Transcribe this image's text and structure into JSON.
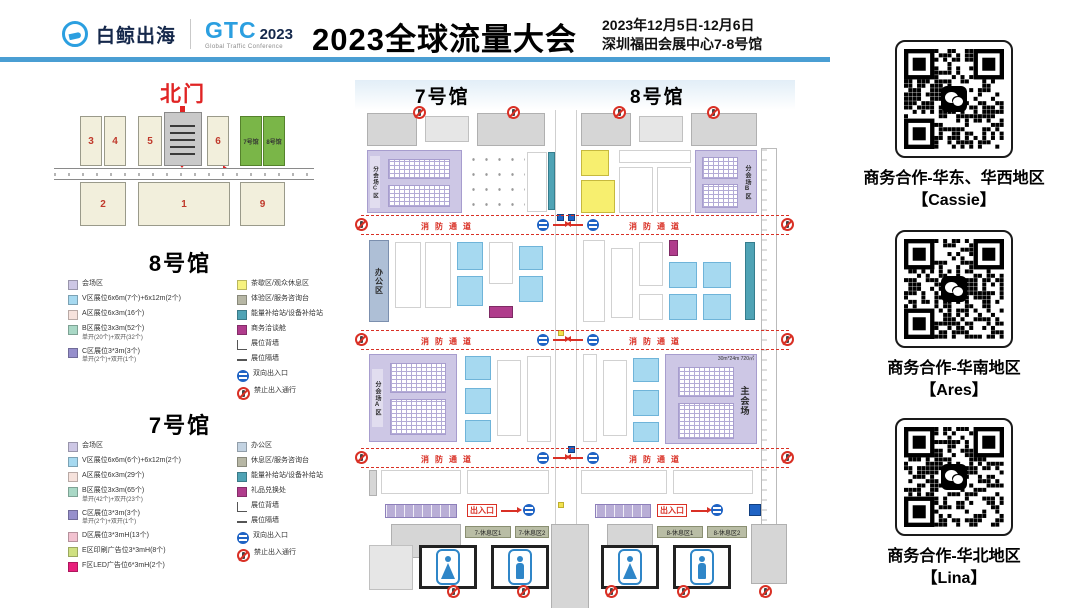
{
  "header": {
    "logo_cn": "白鲸出海",
    "gtc": "GTC",
    "gtc_year": "2023",
    "gtc_sub": "Global Traffic Conference",
    "title": "2023全球流量大会",
    "date": "2023年12月5日-12月6日",
    "venue": "深圳福田会展中心7-8号馆"
  },
  "overview": {
    "north_gate": "北门",
    "hall3": "3",
    "hall4": "4",
    "hall5": "5",
    "hall6": "6",
    "hall2": "2",
    "hall1": "1",
    "hall9": "9",
    "hall7_green": "7号馆",
    "hall8_green": "8号馆"
  },
  "legend8": {
    "title": "8号馆",
    "left": [
      {
        "label": "会场区",
        "color": "#cdc7e5"
      },
      {
        "label": "V区展位6x6m(7个)+6x12m(2个)",
        "color": "#a6d9f0"
      },
      {
        "label": "A区展位6x3m(16个)",
        "color": "#f6e2dc"
      },
      {
        "label": "B区展位3x3m(52个)",
        "sub": "单开(20个)+双开(32个)",
        "color": "#a9d8c6"
      },
      {
        "label": "C区展位3*3m(3个)",
        "sub": "单开(2个)+双开(1个)",
        "color": "#968fcc"
      }
    ],
    "right": [
      {
        "label": "茶歇区/观众休息区",
        "color": "#f7f37e"
      },
      {
        "label": "体验区/服务咨询台",
        "color": "#b7b7a5"
      },
      {
        "label": "能量补给站/设备补给站",
        "color": "#4fa3b5"
      },
      {
        "label": "商务洽谈舱",
        "color": "#b03c8c"
      },
      {
        "label": "展位背墙"
      },
      {
        "label": "展位隔墙"
      },
      {
        "label": "双向出入口"
      },
      {
        "label": "禁止出入通行"
      }
    ]
  },
  "legend7": {
    "title": "7号馆",
    "left": [
      {
        "label": "会场区",
        "color": "#cdc7e5"
      },
      {
        "label": "V区展位6x6m(6个)+6x12m(2个)",
        "color": "#a6d9f0"
      },
      {
        "label": "A区展位6x3m(29个)",
        "color": "#f6e2dc"
      },
      {
        "label": "B区展位3x3m(65个)",
        "sub": "单开(42个)+双开(23个)",
        "color": "#a9d8c6"
      },
      {
        "label": "C区展位3*3m(3个)",
        "sub": "单开(2个)+双开(1个)",
        "color": "#968fcc"
      },
      {
        "label": "D区展位3*3mH(13个)",
        "color": "#f2c2d0"
      },
      {
        "label": "E区印刷广告位3*3mH(8个)",
        "color": "#cfe081"
      },
      {
        "label": "F区LED广告位6*3mH(2个)",
        "color": "#e81f7c"
      }
    ],
    "right": [
      {
        "label": "办公区",
        "color": "#c3d3e2"
      },
      {
        "label": "休息区/服务咨询台",
        "color": "#b7b7a5"
      },
      {
        "label": "能量补给站/设备补给站",
        "color": "#4fa3b5"
      },
      {
        "label": "礼品兑换处",
        "color": "#b03c8c"
      },
      {
        "label": "展位背墙"
      },
      {
        "label": "展位隔墙"
      },
      {
        "label": "双向出入口"
      },
      {
        "label": "禁止出入通行"
      }
    ]
  },
  "floorplan": {
    "hall7_title": "7号馆",
    "hall8_title": "8号馆",
    "office": "办公区",
    "sub_a": "分会场A区",
    "sub_b": "分会场B区",
    "sub_c": "分会场C区",
    "main_hall": "主会场",
    "main_dim": "30m*24m 720㎡",
    "fire_lane": "消防通道",
    "exit": "出入口",
    "rest_7_1": "7-休息区1",
    "rest_7_2": "7-休息区2",
    "rest_8_1": "8-休息区1",
    "rest_8_2": "8-休息区2"
  },
  "qr_contacts": [
    {
      "region": "商务合作-华东、华西地区",
      "name": "【Cassie】"
    },
    {
      "region": "商务合作-华南地区",
      "name": "【Ares】"
    },
    {
      "region": "商务合作-华北地区",
      "name": "【Lina】"
    }
  ],
  "colors": {
    "header_bar": "#4a9ed3",
    "brand_blue": "#2b9fe0",
    "alert_red": "#d93025",
    "hall_green": "#7ab648"
  }
}
